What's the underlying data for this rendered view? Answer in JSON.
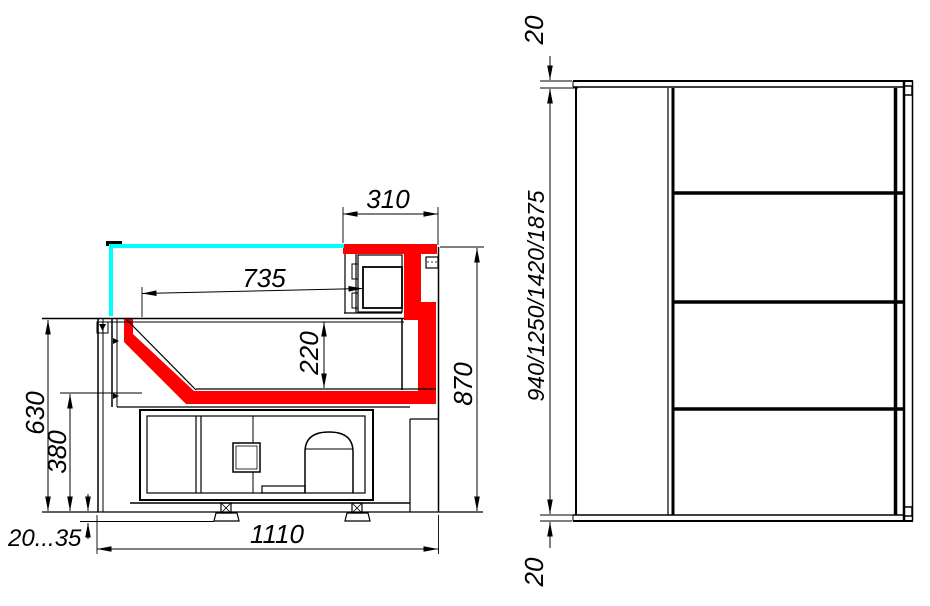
{
  "drawing": {
    "title": "Refrigerated display case dimensional drawing",
    "colors": {
      "highlight": "#ff0000",
      "glass": "#00ffff",
      "line": "#000000",
      "background": "#ffffff"
    },
    "side_view": {
      "canopy_depth": "310",
      "display_depth": "735",
      "well_depth": "220",
      "overall_height": "870",
      "worktop_height": "630",
      "base_height": "380",
      "leg_adjust_range": "20...35",
      "overall_depth": "1110"
    },
    "plan_view": {
      "top_overhang": "20",
      "length_options": "940/1250/1420/1875",
      "bottom_overhang": "20"
    }
  }
}
